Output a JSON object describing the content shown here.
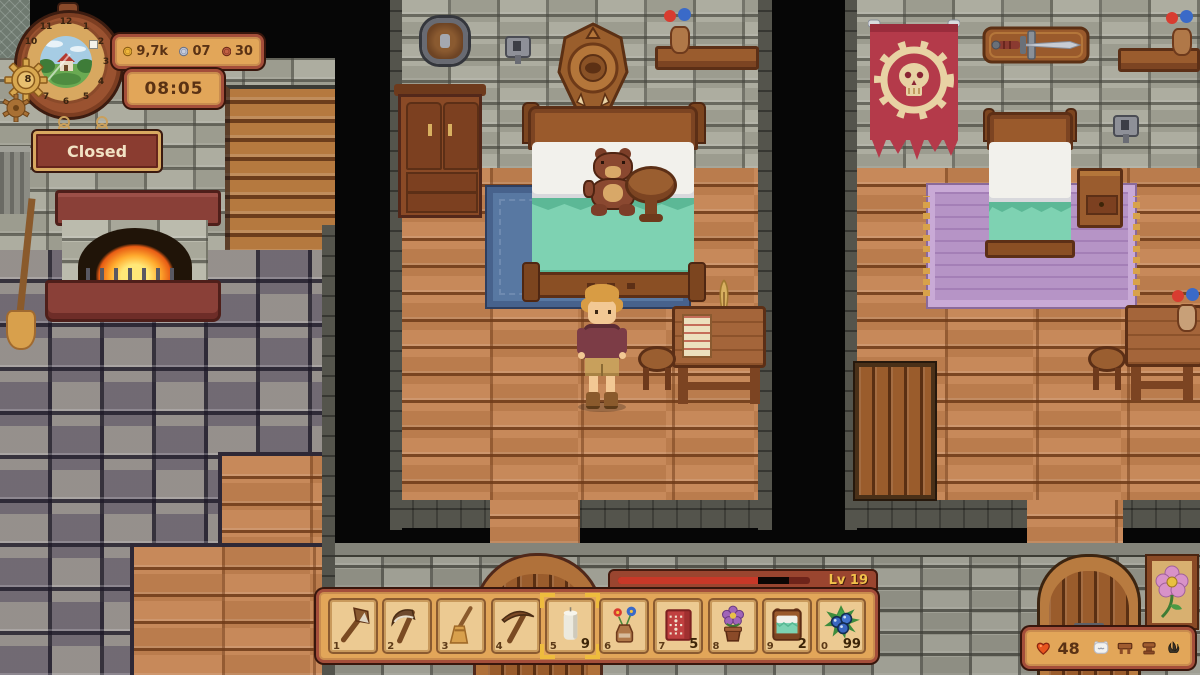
{
  "hud": {
    "clock": {
      "numbers": [
        "12",
        "1",
        "2",
        "3",
        "4",
        "5",
        "6",
        "7",
        "8",
        "9",
        "10",
        "11"
      ]
    },
    "currency": {
      "gold": "9,7k",
      "silver": "07",
      "copper": "30"
    },
    "time": "08:05",
    "status_sign": "Closed",
    "level_badge": "Lv 19",
    "xp_fill_percent": 73,
    "health": "48",
    "hotbar": {
      "slots": [
        {
          "key": "1",
          "item": "axe",
          "count": ""
        },
        {
          "key": "2",
          "item": "scythe",
          "count": ""
        },
        {
          "key": "3",
          "item": "broom",
          "count": ""
        },
        {
          "key": "4",
          "item": "pickaxe",
          "count": ""
        },
        {
          "key": "5",
          "item": "candle",
          "count": "9",
          "selected": true
        },
        {
          "key": "6",
          "item": "flower-vase",
          "count": ""
        },
        {
          "key": "7",
          "item": "red-rug",
          "count": "5"
        },
        {
          "key": "8",
          "item": "potted-flower",
          "count": ""
        },
        {
          "key": "9",
          "item": "bed",
          "count": "2"
        },
        {
          "key": "0",
          "item": "berries",
          "count": "99"
        }
      ]
    }
  },
  "colors": {
    "ui_panel": "#e2a659",
    "ui_border": "#a44e3a",
    "ui_text": "#5a3214",
    "xp_fill": "#c83828",
    "level_text": "#f2c24a",
    "selection": "#eebc3e",
    "health_heart": "#e8551e",
    "sign_bg": "#8a3c30",
    "sign_text": "#f2e2c4",
    "gold_coin": "#f0b83c",
    "silver_coin": "#c9cedd",
    "copper_coin": "#c46244"
  },
  "icons": [
    "gold-coin-icon",
    "silver-coin-icon",
    "copper-coin-icon",
    "heart-icon",
    "pillow-icon",
    "table-icon",
    "stool-icon",
    "sapling-icon",
    "gear-icon",
    "axe-icon",
    "scythe-icon",
    "broom-icon",
    "pickaxe-icon",
    "candle-icon",
    "flower-vase-icon",
    "red-rug-icon",
    "potted-flower-icon",
    "bed-icon",
    "berries-icon"
  ]
}
